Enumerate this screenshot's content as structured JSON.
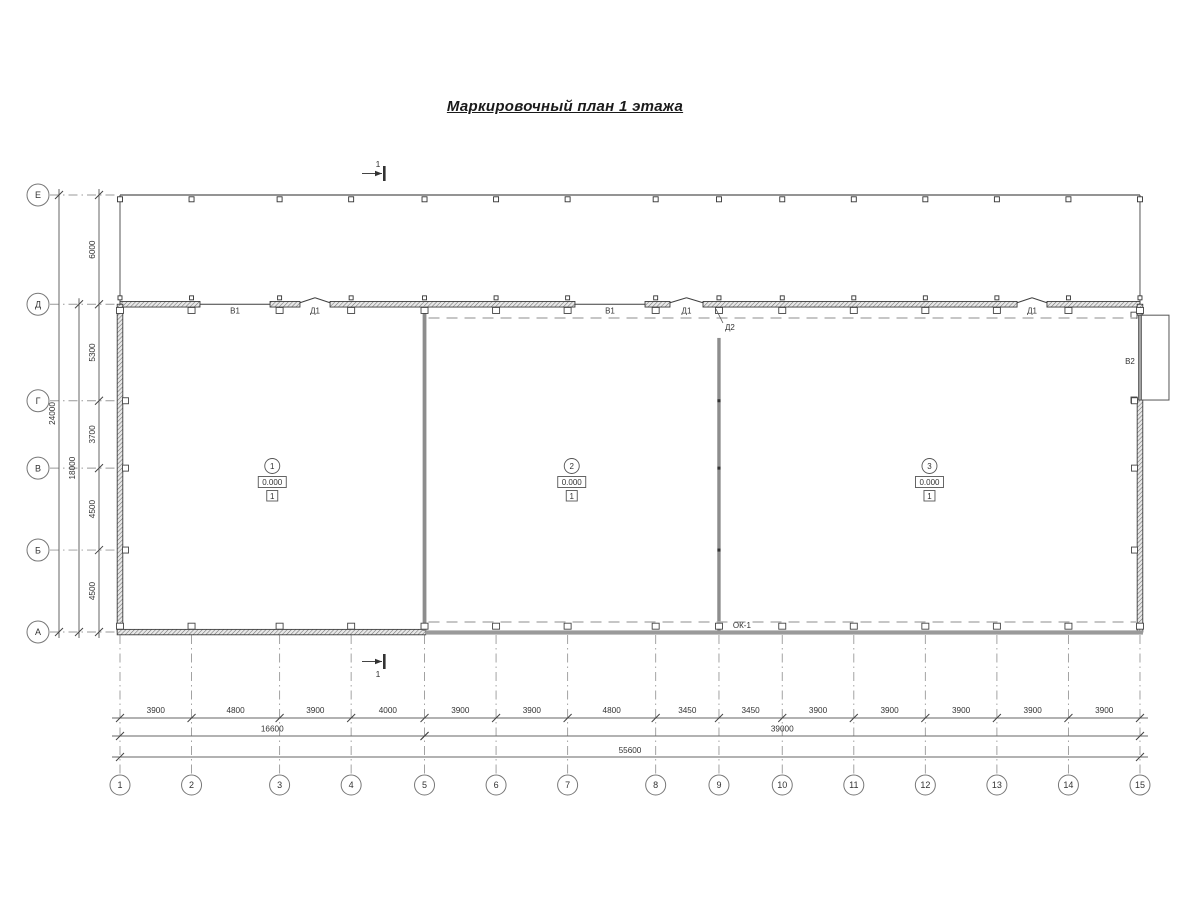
{
  "title": "Маркировочный план 1 этажа",
  "section_label": "1",
  "grid": {
    "column_labels": [
      "1",
      "2",
      "3",
      "4",
      "5",
      "6",
      "7",
      "8",
      "9",
      "10",
      "11",
      "12",
      "13",
      "14",
      "15"
    ],
    "column_spacings_mm": [
      3900,
      4800,
      3900,
      4000,
      3900,
      3900,
      4800,
      3450,
      3450,
      3900,
      3900,
      3900,
      3900,
      3900
    ],
    "row_labels": [
      "Е",
      "Д",
      "Г",
      "В",
      "Б",
      "А"
    ],
    "row_spacings_mm": [
      6000,
      5300,
      3700,
      4500,
      4500
    ]
  },
  "dimensions": {
    "bottom_segments": [
      "3900",
      "4800",
      "3900",
      "4000",
      "3900",
      "3900",
      "4800",
      "3450",
      "3450",
      "3900",
      "3900",
      "3900",
      "3900",
      "3900"
    ],
    "bottom_groups": [
      {
        "from": 0,
        "to": 4,
        "text": "16600"
      },
      {
        "from": 4,
        "to": 14,
        "text": "39000"
      }
    ],
    "bottom_total": {
      "from": 0,
      "to": 14,
      "text": "55600"
    },
    "left_segments": [
      "6000",
      "5300",
      "3700",
      "4500",
      "4500"
    ],
    "left_group": {
      "from_row": 1,
      "to_row": 5,
      "text": "18000"
    },
    "left_total": {
      "from_row": 0,
      "to_row": 5,
      "text": "24000"
    }
  },
  "openings": [
    {
      "kind": "window",
      "label": "В1",
      "wall": "top",
      "from_mm": 4360,
      "to_mm": 8180
    },
    {
      "kind": "door",
      "label": "Д1",
      "wall": "top",
      "from_mm": 9810,
      "to_mm": 11450
    },
    {
      "kind": "window",
      "label": "В1",
      "wall": "top",
      "from_mm": 24800,
      "to_mm": 28620
    },
    {
      "kind": "door",
      "label": "Д1",
      "wall": "top",
      "from_mm": 29980,
      "to_mm": 31780
    },
    {
      "kind": "door",
      "label": "Д2",
      "wall": "partition-9",
      "from_mm": 150,
      "to_mm": 1850
    },
    {
      "kind": "door",
      "label": "Д1",
      "wall": "top",
      "from_mm": 48900,
      "to_mm": 50530
    },
    {
      "kind": "gate",
      "label": "В2",
      "wall": "right",
      "from_mm": 600,
      "to_mm": 5260
    },
    {
      "kind": "window",
      "label": "ОК-1",
      "wall": "bottom",
      "at_mm": 33900
    }
  ],
  "rooms": [
    {
      "number": "1",
      "elevation": "0.000",
      "floor_type": "1"
    },
    {
      "number": "2",
      "elevation": "0.000",
      "floor_type": "1"
    },
    {
      "number": "3",
      "elevation": "0.000",
      "floor_type": "1"
    }
  ],
  "colors": {
    "wall_line": "#3f3f3f",
    "thin_line": "#555555",
    "gray_wall": "#8d8d8d",
    "dim_line": "#666666",
    "grid_dash": "#999999",
    "room_dash": "#b3b3b3",
    "text": "#333333"
  }
}
